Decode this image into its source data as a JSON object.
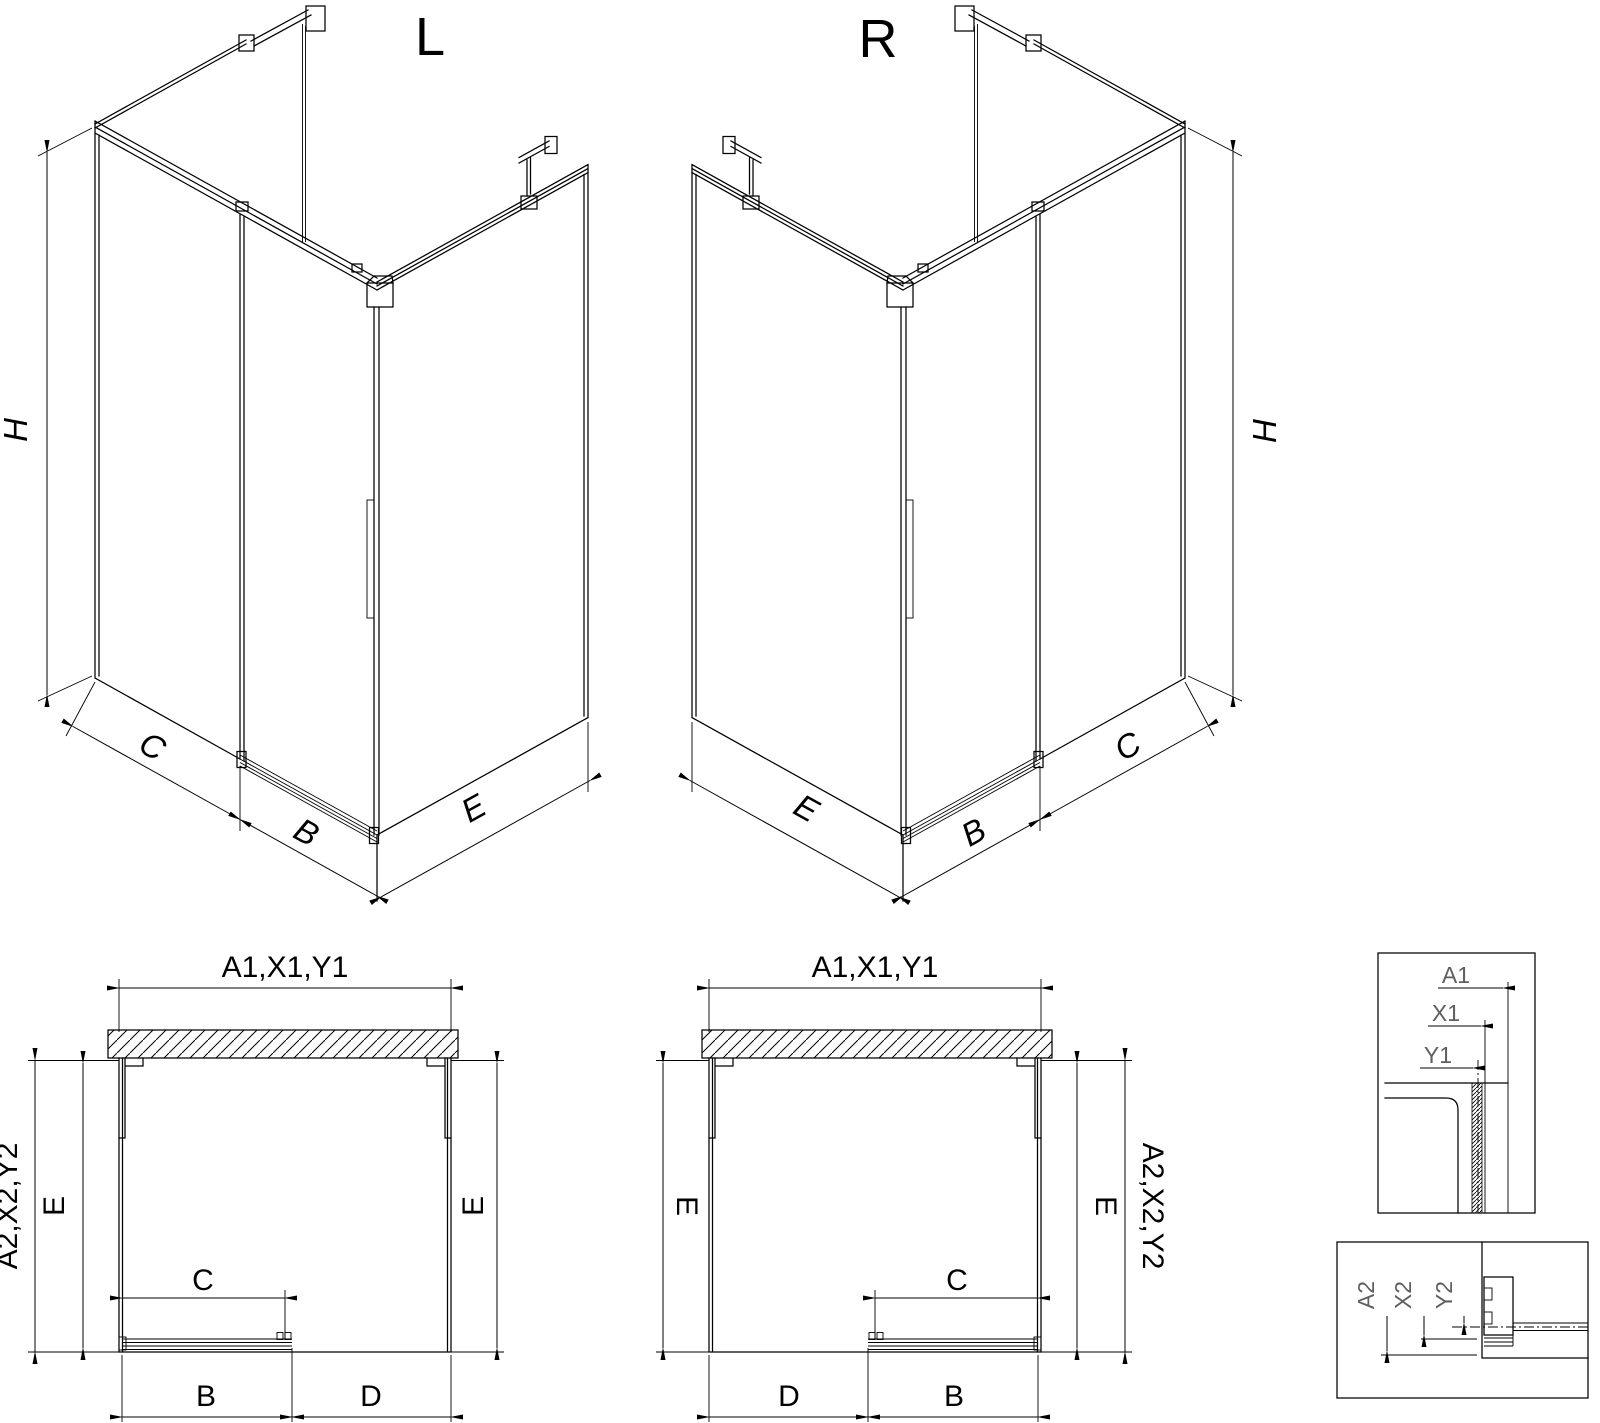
{
  "drawing": {
    "background": "#ffffff",
    "line_color": "#000000",
    "detail_text_color": "#5f5f5f"
  },
  "iso_views": {
    "left": {
      "title": "L",
      "height_label": "H",
      "panel_label": "C",
      "door_label": "B",
      "return_label": "E"
    },
    "right": {
      "title": "R",
      "height_label": "H",
      "panel_label": "C",
      "door_label": "B",
      "return_label": "E"
    }
  },
  "plan_views": {
    "left": {
      "width_label": "A1,X1,Y1",
      "depth_outer_label": "A2,X2,Y2",
      "depth_left_label": "E",
      "depth_right_label": "E",
      "opening_label": "C",
      "door_label": "B",
      "fixed_label": "D"
    },
    "right": {
      "width_label": "A1,X1,Y1",
      "depth_outer_label": "A2,X2,Y2",
      "depth_left_label": "E",
      "depth_right_label": "E",
      "opening_label": "C",
      "door_label": "B",
      "fixed_label": "D"
    }
  },
  "detail_views": {
    "width_profile": {
      "labels": [
        "A1",
        "X1",
        "Y1"
      ]
    },
    "depth_profile": {
      "labels": [
        "A2",
        "X2",
        "Y2"
      ]
    }
  }
}
